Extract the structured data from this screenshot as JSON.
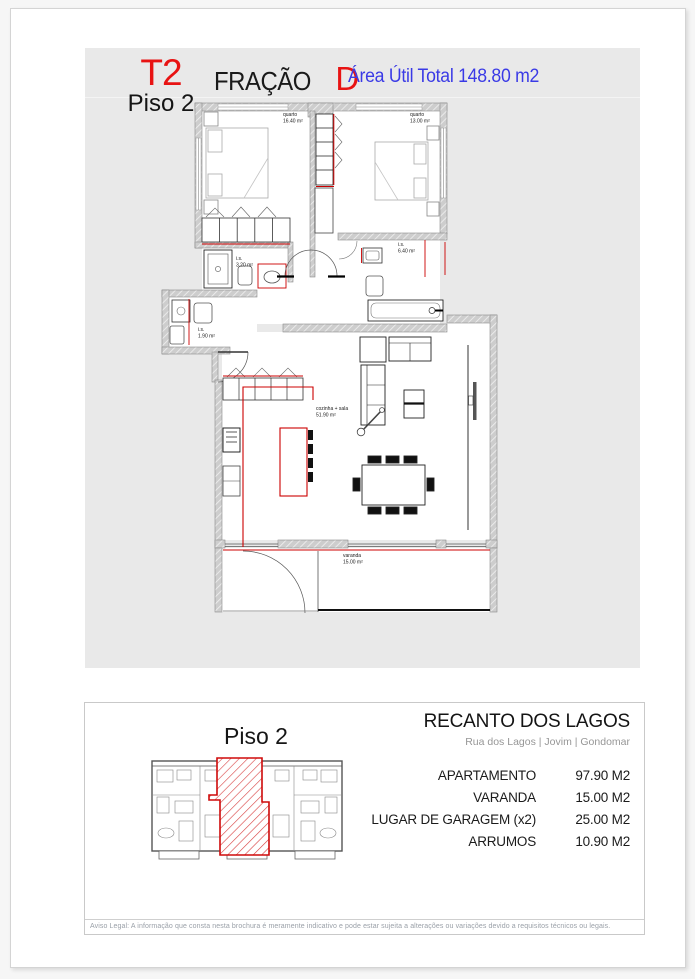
{
  "header": {
    "unit_type": "T2",
    "floor": "Piso 2",
    "fraction_label": "FRAÇÃO",
    "fraction_letter": "D",
    "area_total": "Área Útil Total 148.80 m2"
  },
  "plan": {
    "rooms": [
      {
        "name": "quarto",
        "area": "16.40 m²"
      },
      {
        "name": "quarto",
        "area": "13.00 m²"
      },
      {
        "name": "i.s.",
        "area": "3.20 m²"
      },
      {
        "name": "i.s.",
        "area": "6.40 m²"
      },
      {
        "name": "i.s.",
        "area": "1.90 m²"
      },
      {
        "name": "cozinha + sala",
        "area": "51.90 m²"
      },
      {
        "name": "varanda",
        "area": "15.00 m²"
      }
    ]
  },
  "footer": {
    "floor_title": "Piso 2",
    "project": "RECANTO DOS LAGOS",
    "address": "Rua dos Lagos | Jovim | Gondomar",
    "rows": [
      {
        "label": "APARTAMENTO",
        "value": "97.90 M2"
      },
      {
        "label": "VARANDA",
        "value": "15.00 M2"
      },
      {
        "label": "LUGAR DE GARAGEM (x2)",
        "value": "25.00 M2"
      },
      {
        "label": "ARRUMOS",
        "value": "10.90 M2"
      }
    ],
    "disclaimer": "Aviso Legal: A informação que consta nesta brochura é meramente indicativo e pode estar sujeita a alterações ou variações devido a requisitos técnicos ou legais."
  },
  "colors": {
    "accent_red": "#e81313",
    "accent_blue": "#3a3ae6",
    "plan_red": "#cc0000",
    "panel_gray": "#e9e9e9",
    "varanda_label_blue": "#223377"
  }
}
